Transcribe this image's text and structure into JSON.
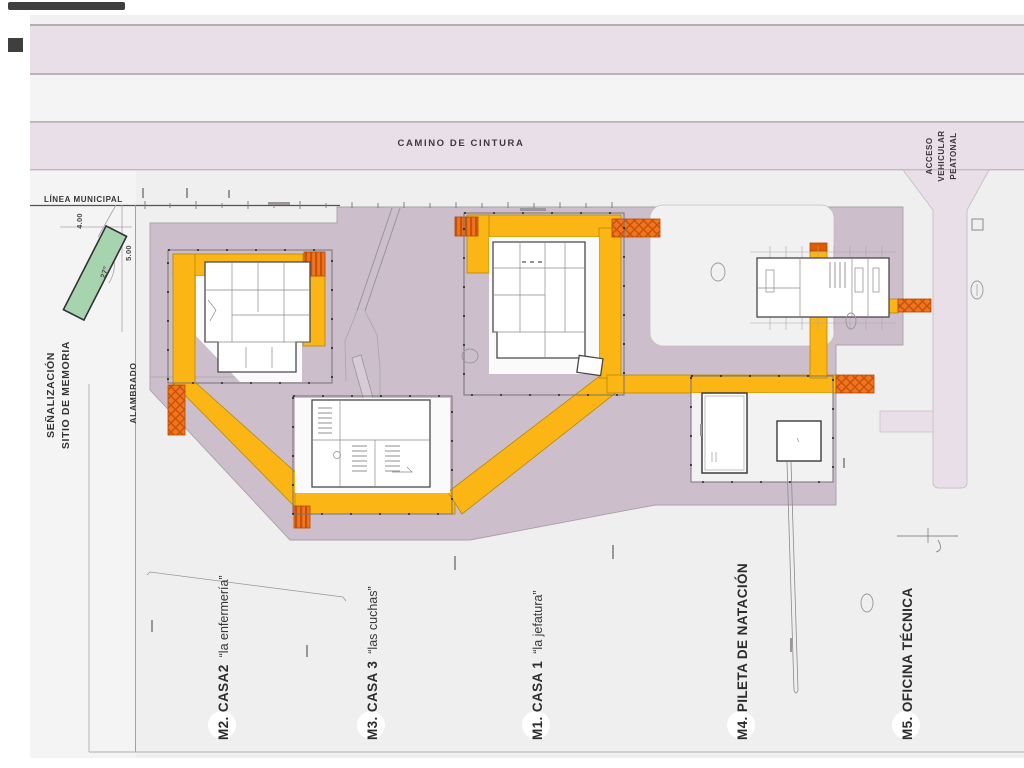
{
  "colors": {
    "field": "#EFEFEF",
    "band_pink": "#E9DFE8",
    "band_light": "#F5F4F5",
    "site_mauve": "#CCBFCB",
    "path_yellow": "#FBB616",
    "connector_orange": "#F4731D",
    "signage_green": "#A6D4AF",
    "plaza_light": "#F2F1F2"
  },
  "road": {
    "label": "CAMINO DE CINTURA"
  },
  "access": {
    "line1": "ACCESO",
    "line2": "VEHICULAR",
    "line3": "PEATONAL"
  },
  "municipal": {
    "label": "LÍNEA MUNICIPAL"
  },
  "signage": {
    "line1": "SEÑALIZACIÓN",
    "line2": "SITIO DE MEMORIA"
  },
  "fence": {
    "label": "ALAMBRADO"
  },
  "dims": {
    "d1": "4.00",
    "d2": "5.00",
    "angle": "27°"
  },
  "markers": [
    {
      "bold": "M2. CASA2",
      "nick": "“la enfermería”"
    },
    {
      "bold": "M3. CASA 3",
      "nick": "“las cuchas”"
    },
    {
      "bold": "M1. CASA 1",
      "nick": "“la jefatura”"
    },
    {
      "bold": "M4. PILETA DE NATACIÓN",
      "nick": ""
    },
    {
      "bold": "M5. OFICINA TÉCNICA",
      "nick": ""
    }
  ]
}
